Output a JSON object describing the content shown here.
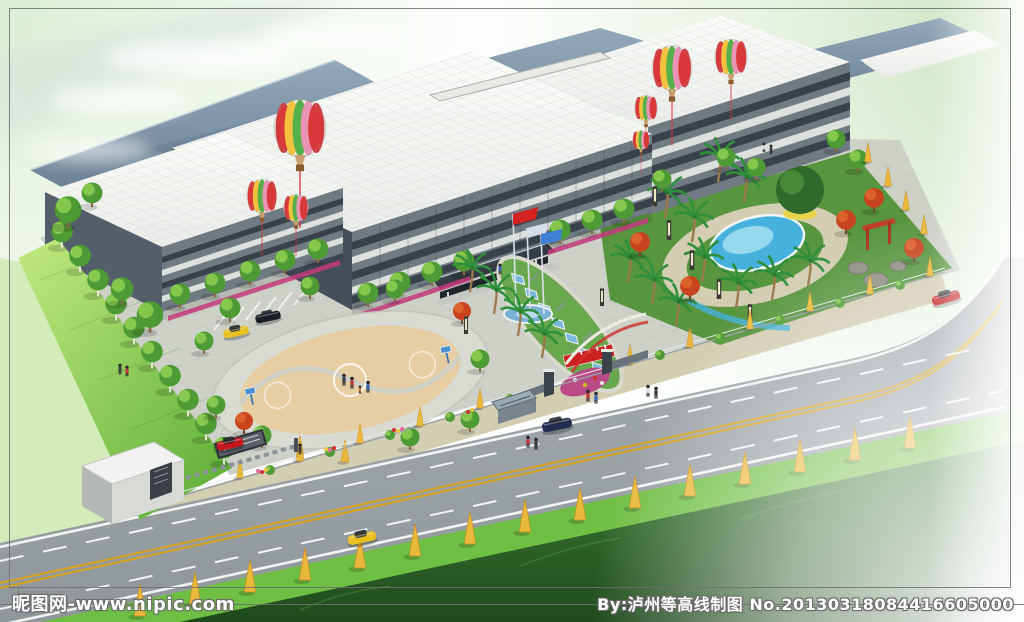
{
  "watermarks": {
    "bottom_left": "昵图网-www.nipic.com",
    "bottom_right": "By:泸州等高线制图 No.20130318084416605000"
  },
  "scene": {
    "type": "architectural-aerial-rendering",
    "subject": "Bird's-eye rendering of a factory campus: white-roofed office buildings, landscaped garden with swimming pool, circular basketball court, flag poles, hot-air balloons, gate house and a tree-lined road"
  },
  "palette": {
    "bg-white": "#ffffff",
    "sky-green-1": "#d8ecd0",
    "sky-green-2": "#c6e0ba",
    "roof-white-1": "#fbfcf9",
    "roof-white-2": "#e9ece8",
    "roof-edge": "#b9bfc0",
    "roof-steel-1": "#93a9ba",
    "roof-steel-2": "#667c90",
    "facade-base": "#707a82",
    "facade-dark": "#39424b",
    "facade-light": "#dde1dd",
    "wall-dark": "#555f6b",
    "wall-darker": "#454f5a",
    "plaza": "#cdd1c8",
    "path-sand": "#d3cdb2",
    "court-ring": "#d9dad1",
    "court-tan": "#e6cda2",
    "lawn-1": "#c2ea80",
    "lawn-2": "#58ab34",
    "left-field": "#d4ecba",
    "verge-green": "#6fbf44",
    "field-1": "#3f7f36",
    "field-2": "#1f4a1c",
    "garden-green": "#58953f",
    "pool-blue": "#45b1dc",
    "pool-light": "#a5dff0",
    "road-1": "#a8aeb2",
    "road-2": "#8f979b",
    "line-white": "#f2f4f2",
    "line-yellow": "#d9a41c",
    "tree-green": "#4e9a34",
    "tree-light": "#8fcf52",
    "palm-green": "#2f8f3a",
    "maple-red": "#c8441e",
    "street-yellow": "#e9b93c",
    "shrub-yellow": "#e5ce4a",
    "flower-magenta": "#c43a7c",
    "flower-red": "#d03030",
    "balloon-cream": "#f3efe2",
    "balloon-red": "#d8383a",
    "balloon-yellow": "#f2c23e",
    "balloon-green": "#56b04a",
    "balloon-pink": "#e993b5",
    "car-red": "#c4161c",
    "car-blue": "#232d52",
    "car-yellow": "#e8c020",
    "car-black": "#1b1f24",
    "flag-red": "#d42222",
    "flag-blue": "#3f7fd4",
    "canopy-glass": "#7ab8dc",
    "banner-red": "#cc2020",
    "lamp-dark": "#3a3a34",
    "rock-gray": "#8d8d83",
    "fence-gray": "#98a0a4",
    "frame-line": "#6e6e6e",
    "trunk-brown": "#8a6a44",
    "big-tree": "#2e6b2b"
  }
}
